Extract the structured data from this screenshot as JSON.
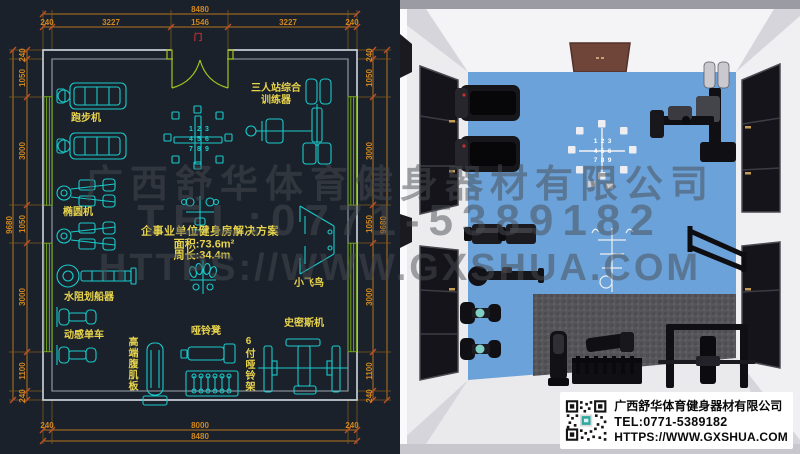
{
  "watermark": {
    "line1": "广西舒华体育健身器材有限公司",
    "line2": "TEL:0771-5389182",
    "line3": "HTTPS://WWW.GXSHUA.COM"
  },
  "cad": {
    "door_label": "门",
    "title_line1": "企事业单位健身房解决方案",
    "title_line2": "面积:73.6m²",
    "title_line3": "周长:34.4m",
    "dims": {
      "top_total": "8480",
      "top": [
        "240",
        "3227",
        "1546",
        "3227",
        "240"
      ],
      "bottom": [
        "240",
        "8000",
        "240"
      ],
      "bottom_total": "8480",
      "left_total": "9680",
      "left": [
        "240",
        "1050",
        "3000",
        "1050",
        "3000",
        "1100",
        "240"
      ],
      "right_total": "9680",
      "right": [
        "240",
        "1050",
        "3000",
        "1050",
        "3000",
        "1100",
        "240"
      ]
    },
    "labels": {
      "treadmill": "跑步机",
      "elliptical": "椭圆机",
      "rower": "水阻划船器",
      "spin_bike": "动感单车",
      "ab_board": "高端腹肌板",
      "dumbbell_bench": "哑铃凳",
      "dumbbell_rack": "6付哑铃架",
      "smith_machine": "史密斯机",
      "cable_fly": "小飞鸟",
      "multi_station_line1": "三人站综合",
      "multi_station_line2": "训练器"
    },
    "rack_numbers": [
      "1",
      "2",
      "3",
      "4",
      "5",
      "6",
      "7",
      "8",
      "9"
    ]
  },
  "render3d": {
    "rack_numbers": [
      "1",
      "2",
      "3",
      "4",
      "5",
      "6",
      "7",
      "8",
      "9"
    ]
  },
  "infobox": {
    "company": "广西舒华体育健身器材有限公司",
    "tel": "TEL:0771-5389182",
    "url": "HTTPS://WWW.GXSHUA.COM"
  },
  "colors": {
    "cad_background": "#1b212b",
    "cad_line_cyan": "#18cbcb",
    "cad_label_yellow": "#e8d44c",
    "cad_dim_orange": "#d0881e",
    "cad_window_green": "#74a31e",
    "cad_door_green": "#a6c21e",
    "door_red": "#c93434",
    "floor_blue": "#6ba2d9",
    "mat_gray": "#55555a",
    "door_brown": "#6f4539"
  }
}
